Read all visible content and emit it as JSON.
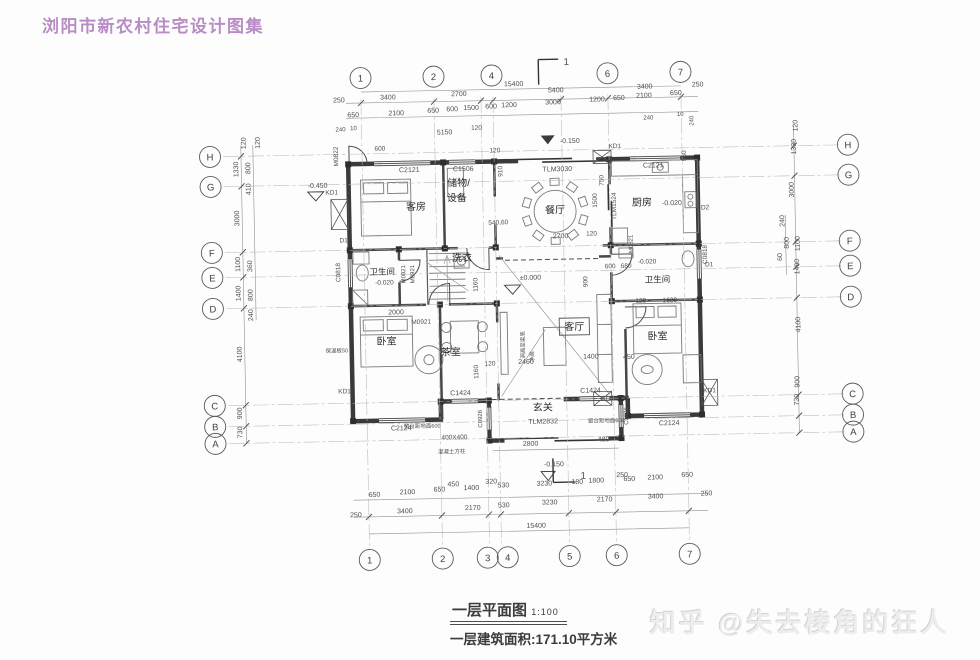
{
  "header": {
    "title": "浏阳市新农村住宅设计图集"
  },
  "caption": {
    "name": "一层平面图",
    "scale": "1:100",
    "area": "一层建筑面积:171.10平方米"
  },
  "watermark": {
    "text": "知乎 @失去棱角的狂人"
  },
  "colors": {
    "title": "#b98cc6",
    "ink": "#3a3a3a",
    "dim": "#4f4f4f"
  },
  "plan": {
    "axes": {
      "top": [
        {
          "l": "1",
          "x": 365
        },
        {
          "l": "2",
          "x": 438
        },
        {
          "l": "4",
          "x": 496
        },
        {
          "l": "6",
          "x": 612
        },
        {
          "l": "7",
          "x": 685
        }
      ],
      "bottom": [
        {
          "l": "1",
          "x": 365
        },
        {
          "l": "2",
          "x": 438
        },
        {
          "l": "3",
          "x": 483,
          "gx": 485
        },
        {
          "l": "4",
          "x": 503,
          "gx": 497
        },
        {
          "l": "5",
          "x": 565
        },
        {
          "l": "6",
          "x": 612
        },
        {
          "l": "7",
          "x": 685
        }
      ],
      "left": [
        {
          "l": "H",
          "y": 151
        },
        {
          "l": "G",
          "y": 181
        },
        {
          "l": "F",
          "y": 247
        },
        {
          "l": "E",
          "y": 272
        },
        {
          "l": "D",
          "y": 303
        },
        {
          "l": "C",
          "y": 400
        },
        {
          "l": "B",
          "y": 421
        },
        {
          "l": "A",
          "y": 438
        }
      ],
      "right": [
        {
          "l": "H",
          "y": 151
        },
        {
          "l": "G",
          "y": 181
        },
        {
          "l": "F",
          "y": 247
        },
        {
          "l": "E",
          "y": 272
        },
        {
          "l": "D",
          "y": 303
        },
        {
          "l": "C",
          "y": 400
        },
        {
          "l": "B",
          "y": 421
        },
        {
          "l": "A",
          "y": 438
        }
      ]
    },
    "rooms": [
      {
        "t": "客房",
        "x": 418,
        "y": 208
      },
      {
        "t": "储物/",
        "x": 461,
        "y": 185
      },
      {
        "t": "设备",
        "x": 459,
        "y": 200
      },
      {
        "t": "餐厅",
        "x": 557,
        "y": 214
      },
      {
        "t": "厨房",
        "x": 644,
        "y": 208
      },
      {
        "t": "洗衣",
        "x": 463,
        "y": 260
      },
      {
        "t": "卫生间",
        "x": 383,
        "y": 272,
        "s": 8.5
      },
      {
        "t": "卫生间",
        "x": 658,
        "y": 285,
        "s": 8.5
      },
      {
        "t": "卧室",
        "x": 386,
        "y": 342
      },
      {
        "t": "茶室",
        "x": 450,
        "y": 354
      },
      {
        "t": "客厅",
        "x": 574,
        "y": 331,
        "box": true
      },
      {
        "t": "卧室",
        "x": 657,
        "y": 342
      },
      {
        "t": "玄关",
        "x": 541,
        "y": 411
      }
    ],
    "annotations": [
      {
        "t": "15400",
        "x": 518,
        "y": 86
      },
      {
        "t": "250",
        "x": 343,
        "y": 99
      },
      {
        "t": "3400",
        "x": 392,
        "y": 97
      },
      {
        "t": "2700",
        "x": 463,
        "y": 95
      },
      {
        "t": "5400",
        "x": 560,
        "y": 93
      },
      {
        "t": "3400",
        "x": 649,
        "y": 91
      },
      {
        "t": "250",
        "x": 702,
        "y": 90
      },
      {
        "t": "650",
        "x": 357,
        "y": 114
      },
      {
        "t": "2100",
        "x": 400,
        "y": 113
      },
      {
        "t": "650",
        "x": 437,
        "y": 111
      },
      {
        "t": "600",
        "x": 456,
        "y": 110
      },
      {
        "t": "1500",
        "x": 475,
        "y": 109
      },
      {
        "t": "600",
        "x": 495,
        "y": 108
      },
      {
        "t": "1200",
        "x": 513,
        "y": 107
      },
      {
        "t": "3000",
        "x": 557,
        "y": 105
      },
      {
        "t": "1200",
        "x": 601,
        "y": 103
      },
      {
        "t": "650",
        "x": 623,
        "y": 102
      },
      {
        "t": "2100",
        "x": 648,
        "y": 100
      },
      {
        "t": "650",
        "x": 680,
        "y": 98
      },
      {
        "t": "240",
        "x": 344,
        "y": 128,
        "s": 6
      },
      {
        "t": "10",
        "x": 357,
        "y": 127,
        "s": 6
      },
      {
        "t": "240",
        "x": 652,
        "y": 122,
        "s": 6
      },
      {
        "t": "10",
        "x": 684,
        "y": 119,
        "s": 6
      },
      {
        "t": "240",
        "x": 697,
        "y": 124,
        "s": 6,
        "r": -90
      },
      {
        "t": "650",
        "x": 371,
        "y": 494
      },
      {
        "t": "2100",
        "x": 404,
        "y": 492
      },
      {
        "t": "650",
        "x": 436,
        "y": 490
      },
      {
        "t": "450",
        "x": 450,
        "y": 485
      },
      {
        "t": "1400",
        "x": 468,
        "y": 489
      },
      {
        "t": "320",
        "x": 488,
        "y": 483
      },
      {
        "t": "530",
        "x": 500,
        "y": 487
      },
      {
        "t": "3230",
        "x": 541,
        "y": 486
      },
      {
        "t": "180",
        "x": 574,
        "y": 485
      },
      {
        "t": "1800",
        "x": 593,
        "y": 484
      },
      {
        "t": "250",
        "x": 619,
        "y": 479
      },
      {
        "t": "650",
        "x": 626,
        "y": 483
      },
      {
        "t": "2100",
        "x": 652,
        "y": 482
      },
      {
        "t": "650",
        "x": 684,
        "y": 480
      },
      {
        "t": "250",
        "x": 352,
        "y": 514
      },
      {
        "t": "3400",
        "x": 401,
        "y": 511
      },
      {
        "t": "2170",
        "x": 469,
        "y": 509
      },
      {
        "t": "530",
        "x": 500,
        "y": 507
      },
      {
        "t": "3230",
        "x": 546,
        "y": 505
      },
      {
        "t": "2170",
        "x": 601,
        "y": 503
      },
      {
        "t": "3400",
        "x": 652,
        "y": 501
      },
      {
        "t": "250",
        "x": 703,
        "y": 499
      },
      {
        "t": "15400",
        "x": 532,
        "y": 528
      },
      {
        "t": "120",
        "x": 249,
        "y": 138,
        "r": -90
      },
      {
        "t": "120",
        "x": 263,
        "y": 138,
        "r": -90
      },
      {
        "t": "1330",
        "x": 241,
        "y": 164,
        "r": -90
      },
      {
        "t": "800",
        "x": 253,
        "y": 163,
        "r": -90
      },
      {
        "t": "410",
        "x": 253,
        "y": 184,
        "r": -90
      },
      {
        "t": "3000",
        "x": 241,
        "y": 213,
        "r": -90
      },
      {
        "t": "1100",
        "x": 241,
        "y": 259,
        "r": -90
      },
      {
        "t": "360",
        "x": 253,
        "y": 261,
        "r": -90
      },
      {
        "t": "1400",
        "x": 241,
        "y": 288,
        "r": -90
      },
      {
        "t": "800",
        "x": 253,
        "y": 290,
        "r": -90
      },
      {
        "t": "240",
        "x": 253,
        "y": 310,
        "r": -90
      },
      {
        "t": "4100",
        "x": 241,
        "y": 349,
        "r": -90
      },
      {
        "t": "900",
        "x": 240,
        "y": 408,
        "r": -90
      },
      {
        "t": "730",
        "x": 240,
        "y": 427,
        "r": -90
      },
      {
        "t": "120",
        "x": 801,
        "y": 131,
        "r": -90
      },
      {
        "t": "1330",
        "x": 799,
        "y": 152,
        "r": -90
      },
      {
        "t": "3000",
        "x": 796,
        "y": 195,
        "r": -90
      },
      {
        "t": "240",
        "x": 786,
        "y": 226,
        "r": -90
      },
      {
        "t": "1100",
        "x": 801,
        "y": 249,
        "r": -90
      },
      {
        "t": "800",
        "x": 790,
        "y": 248,
        "r": -90
      },
      {
        "t": "60",
        "x": 783,
        "y": 262,
        "r": -90
      },
      {
        "t": "1400",
        "x": 800,
        "y": 272,
        "r": -90
      },
      {
        "t": "4100",
        "x": 800,
        "y": 330,
        "r": -90
      },
      {
        "t": "900",
        "x": 798,
        "y": 387,
        "r": -90
      },
      {
        "t": "730",
        "x": 797,
        "y": 405,
        "r": -90
      },
      {
        "t": "M0822",
        "x": 341,
        "y": 153,
        "r": -90,
        "s": 6.5
      },
      {
        "t": "600",
        "x": 383,
        "y": 148,
        "s": 6.5
      },
      {
        "t": "5150",
        "x": 448,
        "y": 133
      },
      {
        "t": "120",
        "x": 480,
        "y": 129,
        "s": 6.5
      },
      {
        "t": "C2121",
        "x": 412,
        "y": 170
      },
      {
        "t": "C1506",
        "x": 466,
        "y": 170
      },
      {
        "t": "910",
        "x": 505,
        "y": 171,
        "r": -90,
        "s": 6.5
      },
      {
        "t": "-0.150",
        "x": 573,
        "y": 144
      },
      {
        "t": "KD1",
        "x": 618,
        "y": 150,
        "s": 6.5
      },
      {
        "t": "C2121",
        "x": 656,
        "y": 170
      },
      {
        "t": "960",
        "x": 689,
        "y": 159,
        "r": -90,
        "s": 6.5
      },
      {
        "t": "-0.450",
        "x": 320,
        "y": 184
      },
      {
        "t": "KD1",
        "x": 334,
        "y": 191,
        "s": 6.5
      },
      {
        "t": "TLM3030",
        "x": 560,
        "y": 172
      },
      {
        "t": "120",
        "x": 498,
        "y": 152,
        "s": 6.5
      },
      {
        "t": "D1",
        "x": 345,
        "y": 239,
        "s": 6.5
      },
      {
        "t": "C0818",
        "x": 341,
        "y": 269,
        "r": -90,
        "s": 6.5
      },
      {
        "t": "-0.020",
        "x": 385,
        "y": 282,
        "s": 6.5
      },
      {
        "t": "M0821",
        "x": 406,
        "y": 272,
        "r": -90,
        "s": 6
      },
      {
        "t": "M0921",
        "x": 415,
        "y": 272,
        "r": -90,
        "s": 6
      },
      {
        "t": "1160",
        "x": 478,
        "y": 284,
        "r": -90,
        "s": 6.5
      },
      {
        "t": "750",
        "x": 606,
        "y": 182,
        "r": -90,
        "s": 6.5
      },
      {
        "t": "1500",
        "x": 599,
        "y": 202,
        "r": -90,
        "s": 6.5
      },
      {
        "t": "TLM1524",
        "x": 618,
        "y": 208,
        "r": -90,
        "s": 6.5
      },
      {
        "t": "-0.020",
        "x": 674,
        "y": 208,
        "s": 7
      },
      {
        "t": "D2",
        "x": 707,
        "y": 213,
        "s": 6.5
      },
      {
        "t": "540,60",
        "x": 500,
        "y": 224,
        "s": 6.5
      },
      {
        "t": "2700",
        "x": 562,
        "y": 239
      },
      {
        "t": "120",
        "x": 593,
        "y": 237,
        "s": 6.5
      },
      {
        "t": "600",
        "x": 611,
        "y": 270,
        "s": 6.5
      },
      {
        "t": "680",
        "x": 627,
        "y": 270,
        "s": 6.5
      },
      {
        "t": "-0.020",
        "x": 648,
        "y": 266,
        "s": 6.5
      },
      {
        "t": "M0821",
        "x": 634,
        "y": 246,
        "r": -90,
        "s": 6
      },
      {
        "t": "C0818",
        "x": 708,
        "y": 258,
        "r": -90,
        "s": 6.5
      },
      {
        "t": "D1",
        "x": 710,
        "y": 270,
        "s": 6.5
      },
      {
        "t": "±0.000",
        "x": 531,
        "y": 280
      },
      {
        "t": "900",
        "x": 588,
        "y": 283,
        "r": -90,
        "s": 6.5
      },
      {
        "t": "2000",
        "x": 396,
        "y": 312
      },
      {
        "t": "M0921",
        "x": 421,
        "y": 322,
        "s": 6.5
      },
      {
        "t": "120",
        "x": 641,
        "y": 305,
        "s": 6.5
      },
      {
        "t": "1680",
        "x": 670,
        "y": 305,
        "s": 6.5
      },
      {
        "t": "洞高至梁底",
        "x": 524,
        "y": 345,
        "r": -90,
        "s": 5.5
      },
      {
        "t": "净高",
        "x": 533,
        "y": 357,
        "r": -90,
        "s": 5.5
      },
      {
        "t": "2460",
        "x": 525,
        "y": 364
      },
      {
        "t": "1400",
        "x": 590,
        "y": 360
      },
      {
        "t": "450",
        "x": 628,
        "y": 361
      },
      {
        "t": "1160",
        "x": 477,
        "y": 371,
        "r": -90,
        "s": 6.5
      },
      {
        "t": "120",
        "x": 489,
        "y": 365,
        "s": 6.5
      },
      {
        "t": "C1424",
        "x": 459,
        "y": 394
      },
      {
        "t": "C1424",
        "x": 589,
        "y": 394
      },
      {
        "t": "C0926",
        "x": 480,
        "y": 418,
        "r": -90,
        "s": 6
      },
      {
        "t": "C0926",
        "x": 626,
        "y": 418,
        "r": -90,
        "s": 6
      },
      {
        "t": "KD1",
        "x": 343,
        "y": 390,
        "s": 6.5
      },
      {
        "t": "KD3",
        "x": 606,
        "y": 402,
        "s": 6.5
      },
      {
        "t": "KD1",
        "x": 708,
        "y": 396,
        "s": 6.5
      },
      {
        "t": "C2124",
        "x": 399,
        "y": 428
      },
      {
        "t": "C2124",
        "x": 667,
        "y": 428
      },
      {
        "t": "TLM2832",
        "x": 541,
        "y": 424
      },
      {
        "t": "窗台距地面600",
        "x": 420,
        "y": 426,
        "s": 5.5
      },
      {
        "t": "窗台距地面600",
        "x": 604,
        "y": 424,
        "s": 5.5
      },
      {
        "t": "400X400",
        "x": 452,
        "y": 438,
        "s": 6.5
      },
      {
        "t": "混凝土方柱",
        "x": 449,
        "y": 452,
        "s": 5.5
      },
      {
        "t": "保温板50",
        "x": 336,
        "y": 349,
        "s": 5.5
      },
      {
        "t": "2800",
        "x": 528,
        "y": 446
      },
      {
        "t": "480",
        "x": 601,
        "y": 443
      },
      {
        "t": "-0.150",
        "x": 551,
        "y": 467
      },
      {
        "t": "1",
        "x": 571,
        "y": 66,
        "s": 10
      },
      {
        "t": "1",
        "x": 580,
        "y": 480,
        "s": 10
      }
    ]
  }
}
